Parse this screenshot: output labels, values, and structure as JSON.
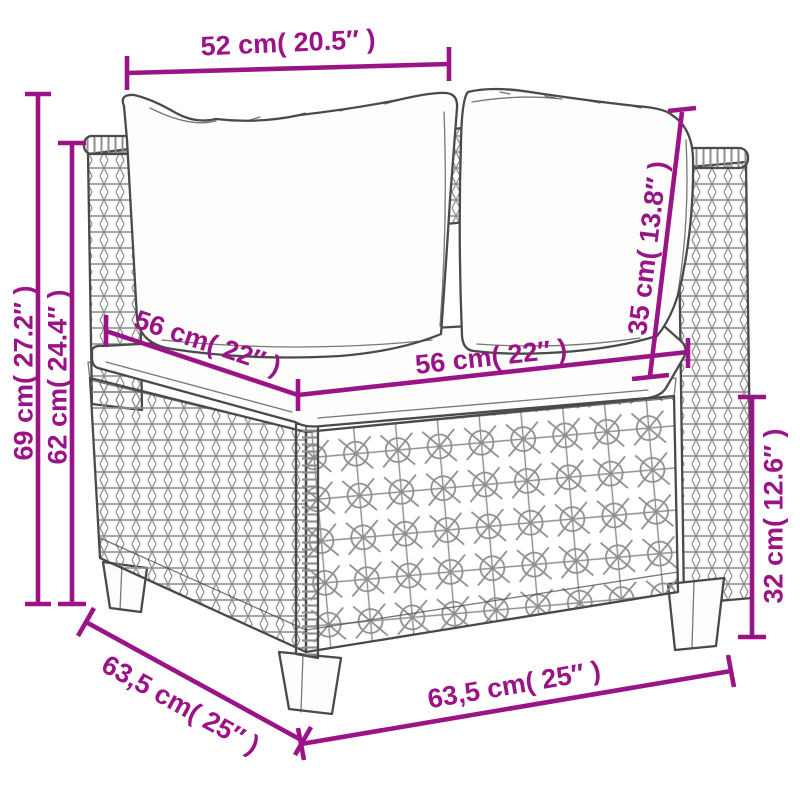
{
  "diagram": {
    "kind": "product-dimension-diagram",
    "subject": "poly-rattan corner sofa section with back cushions and seat cushion"
  },
  "colors": {
    "dimension_accent": "#9B1487",
    "line_art": "#4A4A4A",
    "texture": "#8F8F8F",
    "background": "#FFFFFF"
  },
  "dimensions": {
    "top_width": {
      "label": "52 cm( 20.5″ )",
      "cm": "52",
      "inches": "20.5"
    },
    "left_outer_height": {
      "label": "69 cm( 27.2″ )",
      "cm": "69",
      "inches": "27.2"
    },
    "left_inner_height": {
      "label": "62 cm( 24.4″ )",
      "cm": "62",
      "inches": "24.4"
    },
    "back_cushion_height": {
      "label": "35 cm( 13.8″ )",
      "cm": "35",
      "inches": "13.8"
    },
    "seat_depth": {
      "label": "56 cm( 22″ )",
      "cm": "56",
      "inches": "22"
    },
    "seat_width": {
      "label": "56 cm( 22″ )",
      "cm": "56",
      "inches": "22"
    },
    "base_height": {
      "label": "32 cm( 12.6″ )",
      "cm": "32",
      "inches": "12.6"
    },
    "bottom_depth": {
      "label": "63,5 cm( 25″ )",
      "cm": "63,5",
      "inches": "25"
    },
    "bottom_width": {
      "label": "63,5 cm( 25″ )",
      "cm": "63,5",
      "inches": "25"
    }
  }
}
